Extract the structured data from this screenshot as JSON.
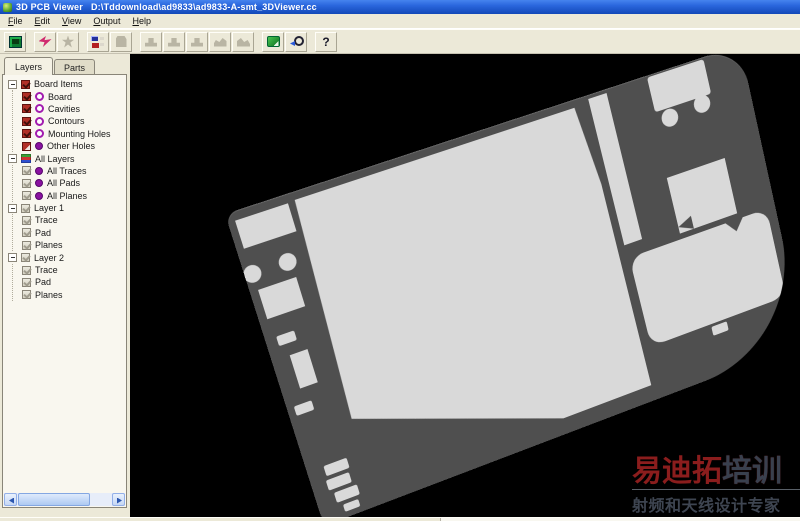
{
  "window": {
    "app_title": "3D PCB Viewer",
    "document_path": "D:\\Tddownload\\ad9833\\ad9833-A-smt_3DViewer.cc"
  },
  "menu": {
    "items": [
      "File",
      "Edit",
      "View",
      "Output",
      "Help"
    ]
  },
  "toolbar": {
    "buttons": [
      "board-view",
      "redraw-flash",
      "star-options",
      "layer-colors",
      "export-container",
      "push-1",
      "push-2",
      "push-3",
      "push-4",
      "sweep",
      "snapshot",
      "zoom-fit",
      "help"
    ],
    "help_glyph": "?"
  },
  "sidebar": {
    "tabs": [
      {
        "label": "Layers",
        "active": true
      },
      {
        "label": "Parts",
        "active": false
      }
    ],
    "tree": [
      {
        "label": "Board Items",
        "checkbox": "red-checked",
        "icon": "none"
      },
      {
        "label": "Board",
        "checkbox": "red-checked",
        "icon": "purple-ring"
      },
      {
        "label": "Cavities",
        "checkbox": "red-checked",
        "icon": "purple-ring"
      },
      {
        "label": "Contours",
        "checkbox": "red-checked",
        "icon": "purple-ring"
      },
      {
        "label": "Mounting Holes",
        "checkbox": "red-checked",
        "icon": "purple-ring"
      },
      {
        "label": "Other Holes",
        "checkbox": "red-folded",
        "icon": "purple-dot"
      },
      {
        "label": "All Layers",
        "checkbox": "none",
        "icon": "layer-stack"
      },
      {
        "label": "All Traces",
        "checkbox": "gray-checked",
        "icon": "purple-dot"
      },
      {
        "label": "All Pads",
        "checkbox": "gray-checked",
        "icon": "purple-dot"
      },
      {
        "label": "All Planes",
        "checkbox": "gray-checked",
        "icon": "purple-dot"
      },
      {
        "label": "Layer 1",
        "checkbox": "gray-checked",
        "icon": "none"
      },
      {
        "label": "Trace",
        "checkbox": "gray-checked",
        "icon": "none"
      },
      {
        "label": "Pad",
        "checkbox": "gray-checked",
        "icon": "none"
      },
      {
        "label": "Planes",
        "checkbox": "gray-checked",
        "icon": "none"
      },
      {
        "label": "Layer 2",
        "checkbox": "gray-checked",
        "icon": "none"
      },
      {
        "label": "Trace",
        "checkbox": "gray-checked",
        "icon": "none"
      },
      {
        "label": "Pad",
        "checkbox": "gray-checked",
        "icon": "none"
      },
      {
        "label": "Planes",
        "checkbox": "gray-checked",
        "icon": "none"
      }
    ]
  },
  "watermark": {
    "brand_red": "易迪拓",
    "brand_dark": "培训",
    "slogan": "射频和天线设计专家"
  },
  "colors": {
    "titlebar_blue": "#2a66dd",
    "chrome_beige": "#ece9d8",
    "viewport_background": "#000000",
    "board_gray": "#4f4f4f",
    "copper_light": "#d9d9d9",
    "checkbox_red": "#b13028",
    "node_purple": "#a21caf",
    "watermark_red": "#8b1d1d"
  }
}
